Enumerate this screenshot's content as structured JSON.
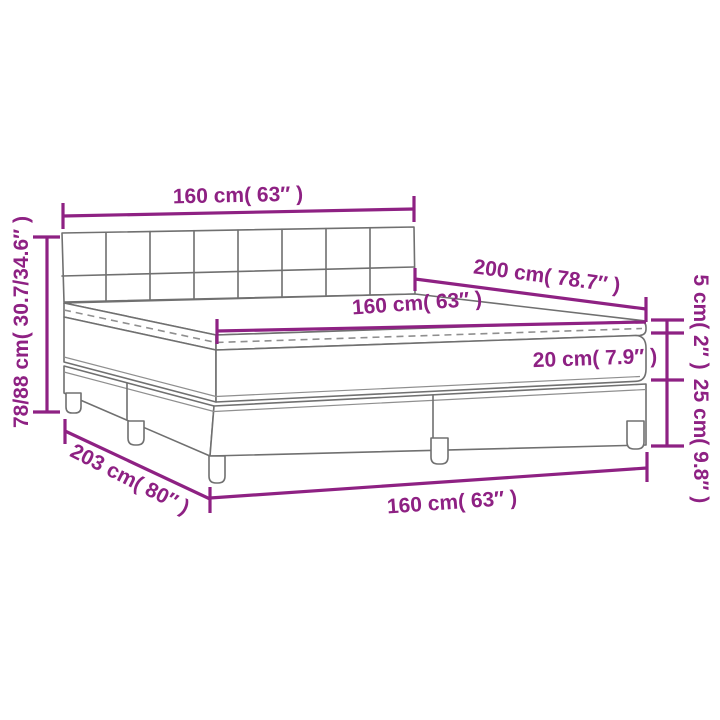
{
  "diagram": {
    "title": "box-spring-bed-dimension-diagram",
    "labels": {
      "top_width": "160 cm( 63″ )",
      "left_height": "78/88 cm( 30.7/34.6″ )",
      "length": "200 cm( 78.7″ )",
      "mattress_width": "160 cm( 63″ )",
      "topper_height": "5 cm( 2″ )",
      "mattress_height": "20 cm( 7.9″ )",
      "base_height": "25 cm( 9.8″ )",
      "diagonal_length": "203 cm( 80″ )",
      "bottom_width": "160 cm( 63″ )"
    },
    "colors": {
      "dimension": "#8E2183",
      "bed_line": "#707070",
      "background": "#FFFFFF"
    }
  }
}
